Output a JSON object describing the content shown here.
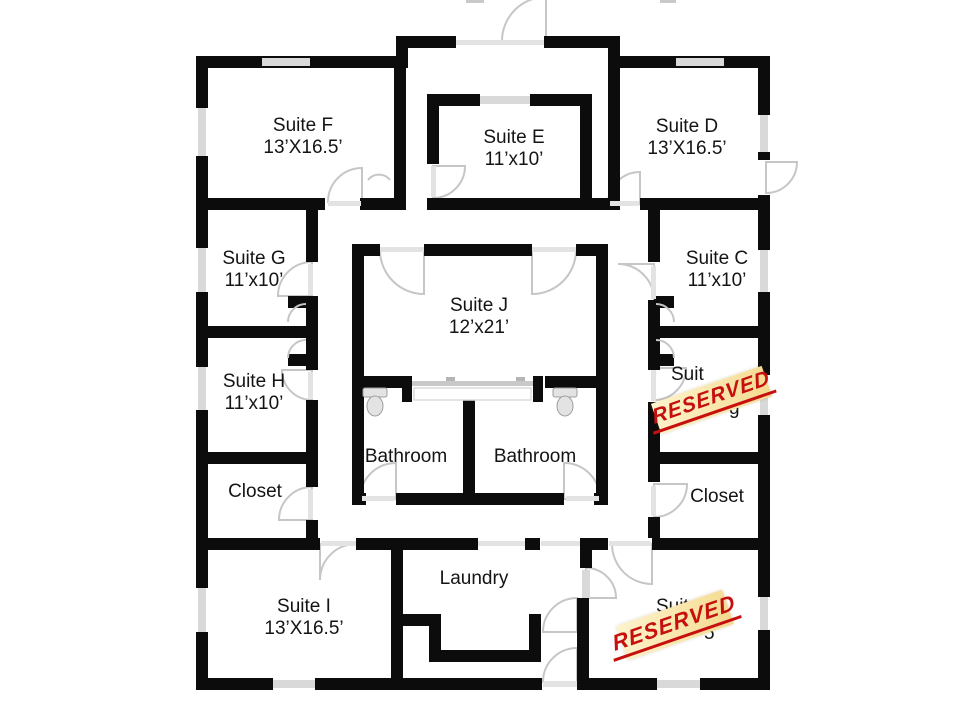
{
  "floorplan": {
    "type": "office-suite floor plan",
    "rooms": [
      {
        "id": "suite-f",
        "name": "Suite F",
        "dims": "13’X16.5’"
      },
      {
        "id": "suite-e",
        "name": "Suite E",
        "dims": "11’x10’"
      },
      {
        "id": "suite-d",
        "name": "Suite D",
        "dims": "13’X16.5’"
      },
      {
        "id": "suite-g",
        "name": "Suite G",
        "dims": "11’x10’"
      },
      {
        "id": "suite-j",
        "name": "Suite J",
        "dims": "12’x21’"
      },
      {
        "id": "suite-c",
        "name": "Suite C",
        "dims": "11’x10’"
      },
      {
        "id": "suite-h",
        "name": "Suite H",
        "dims": "11’x10’"
      },
      {
        "id": "closet-left",
        "name": "Closet"
      },
      {
        "id": "bathroom-left",
        "name": "Bathroom"
      },
      {
        "id": "bathroom-right",
        "name": "Bathroom"
      },
      {
        "id": "closet-right",
        "name": "Closet"
      },
      {
        "id": "laundry",
        "name": "Laundry"
      },
      {
        "id": "suite-i",
        "name": "Suite I",
        "dims": "13’X16.5’"
      }
    ],
    "reserved_rooms": [
      {
        "id": "reserved-middle-right",
        "visible_name_fragment": "Suit",
        "visible_dim_fragment": "g",
        "stamp": "RESERVED"
      },
      {
        "id": "reserved-bottom-right",
        "visible_name_fragment": "Suit",
        "visible_dim_fragment": "5",
        "stamp": "RESERVED"
      }
    ],
    "stamp_style": {
      "text_color": "#c6100e",
      "background": "#f9e6ac"
    },
    "colors": {
      "wall": "#0c0c0c",
      "window": "#d9d9d9",
      "door_arc": "#c6c6c6",
      "background": "#ffffff",
      "label_text": "#141414"
    }
  }
}
